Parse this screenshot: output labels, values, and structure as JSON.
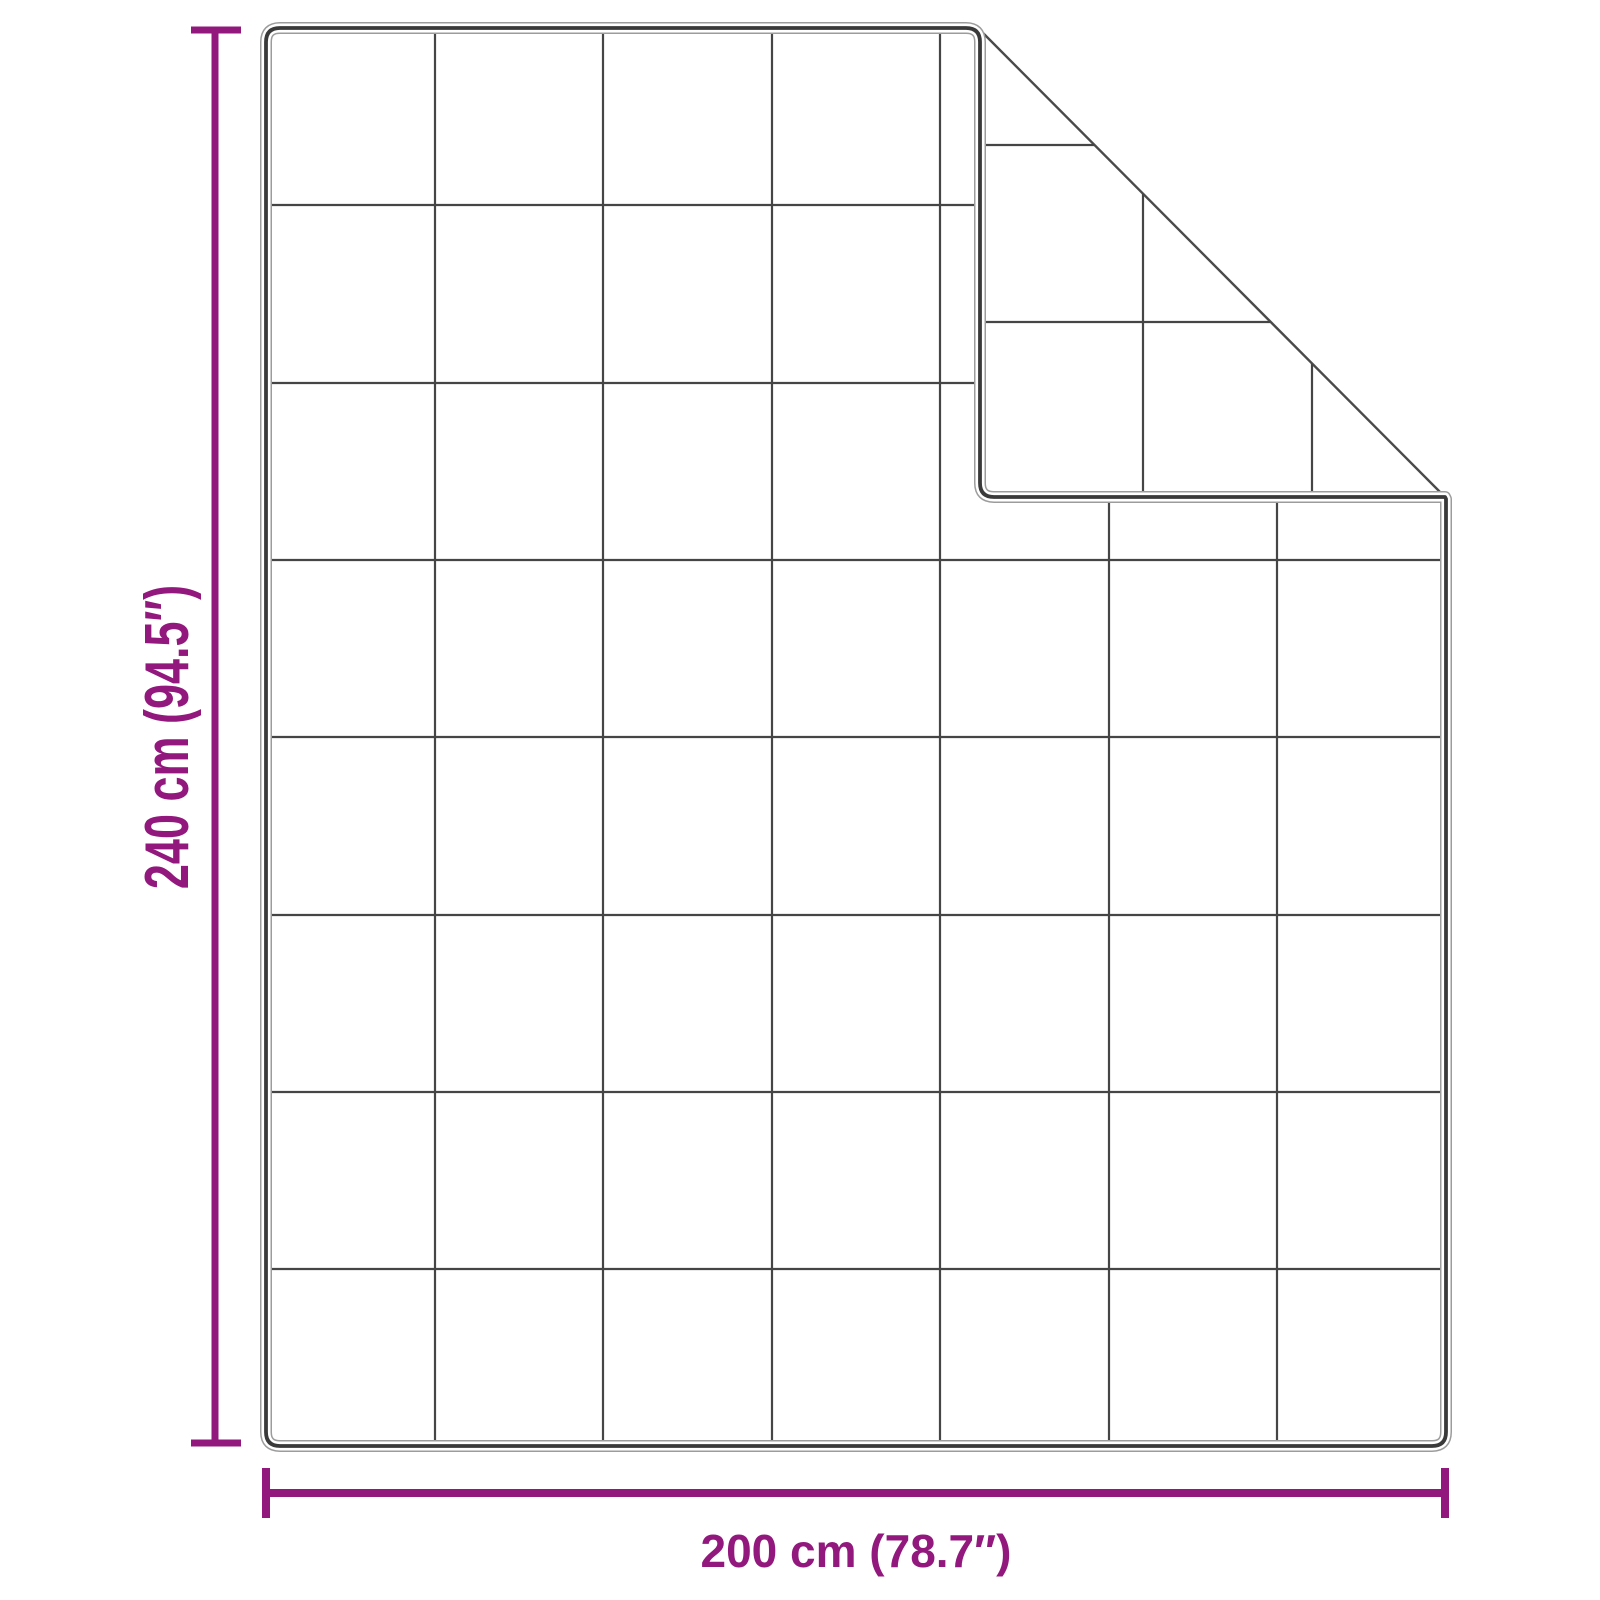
{
  "diagram": {
    "height_label": "240 cm (94.5″)",
    "width_label": "200 cm (78.7″)",
    "quilt_grid": {
      "columns": 7,
      "rows": 8
    },
    "folded_corner": "top-right"
  },
  "colors": {
    "accent": "#92187D",
    "fabric_outline": "#3A3A3A",
    "fabric_outline_halo": "#9C9C9C",
    "quilt_line": "#454545",
    "crease_line": "#4A4A4A",
    "background": "#FFFFFF"
  }
}
